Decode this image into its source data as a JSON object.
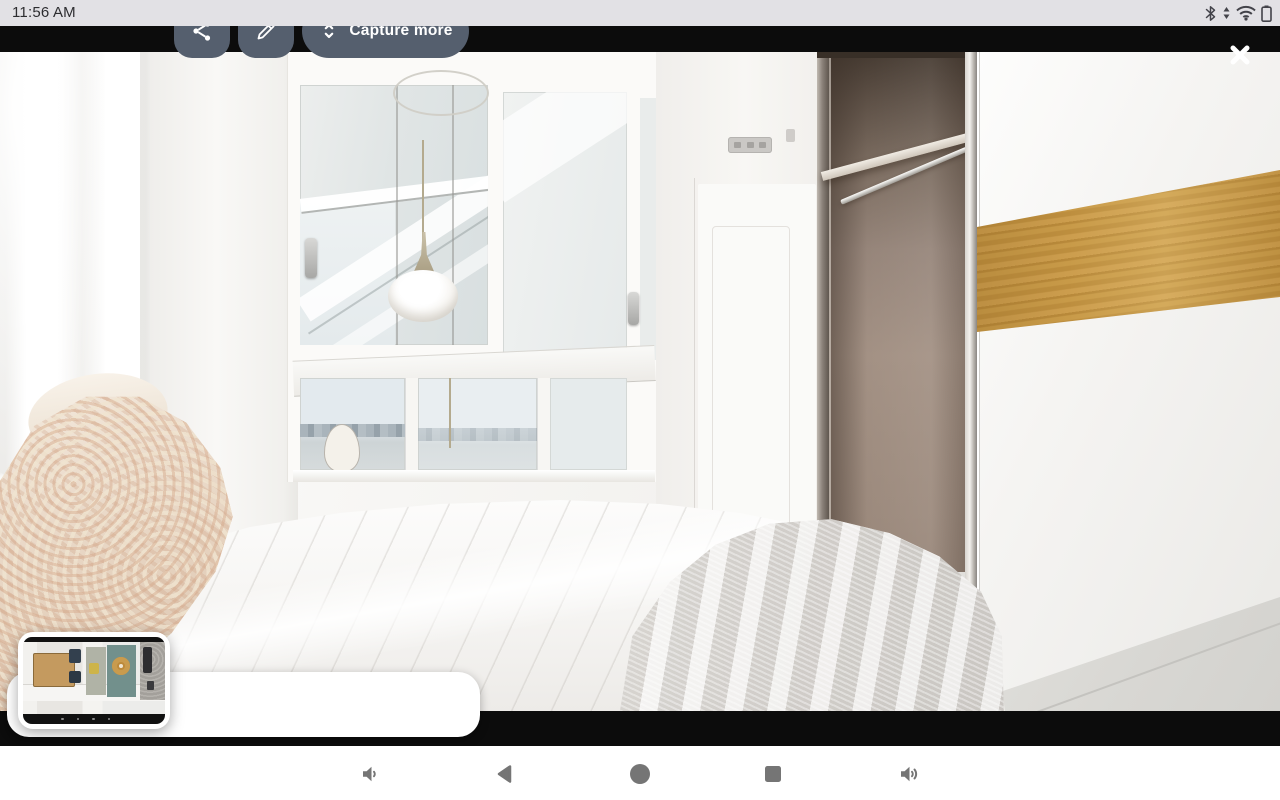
{
  "status_bar": {
    "time": "11:56 AM",
    "icons": [
      "bluetooth-icon",
      "network-updown-wifi-icon",
      "battery-icon"
    ],
    "bg_color": "#e2e1e5",
    "text_color": "#2d2d30"
  },
  "screenshot_preview": {
    "capture_more_label": "Capture more",
    "close_icon": "close-icon",
    "share_icon": "share-icon",
    "edit_icon": "edit-pencil-icon",
    "expand_icon": "unfold-more-icon",
    "action_button_color": "#555f6e",
    "letterbox_color": "#0c0c0c",
    "photo_subject": "bedroom with white bed, windows, pendant lamp, open closet and oak-accent wardrobe",
    "thumbnail_subject": "top-down room screenshot thumbnail"
  },
  "nav_bar": {
    "icon_color": "#757575",
    "items": [
      {
        "name": "volume-down-icon"
      },
      {
        "name": "back-icon"
      },
      {
        "name": "home-icon"
      },
      {
        "name": "recents-icon"
      },
      {
        "name": "volume-up-icon"
      }
    ]
  },
  "colors": {
    "wood_accent": "#c6973f",
    "closet_taupe": "#9c8a7d",
    "nav_bg": "#ffffff"
  }
}
